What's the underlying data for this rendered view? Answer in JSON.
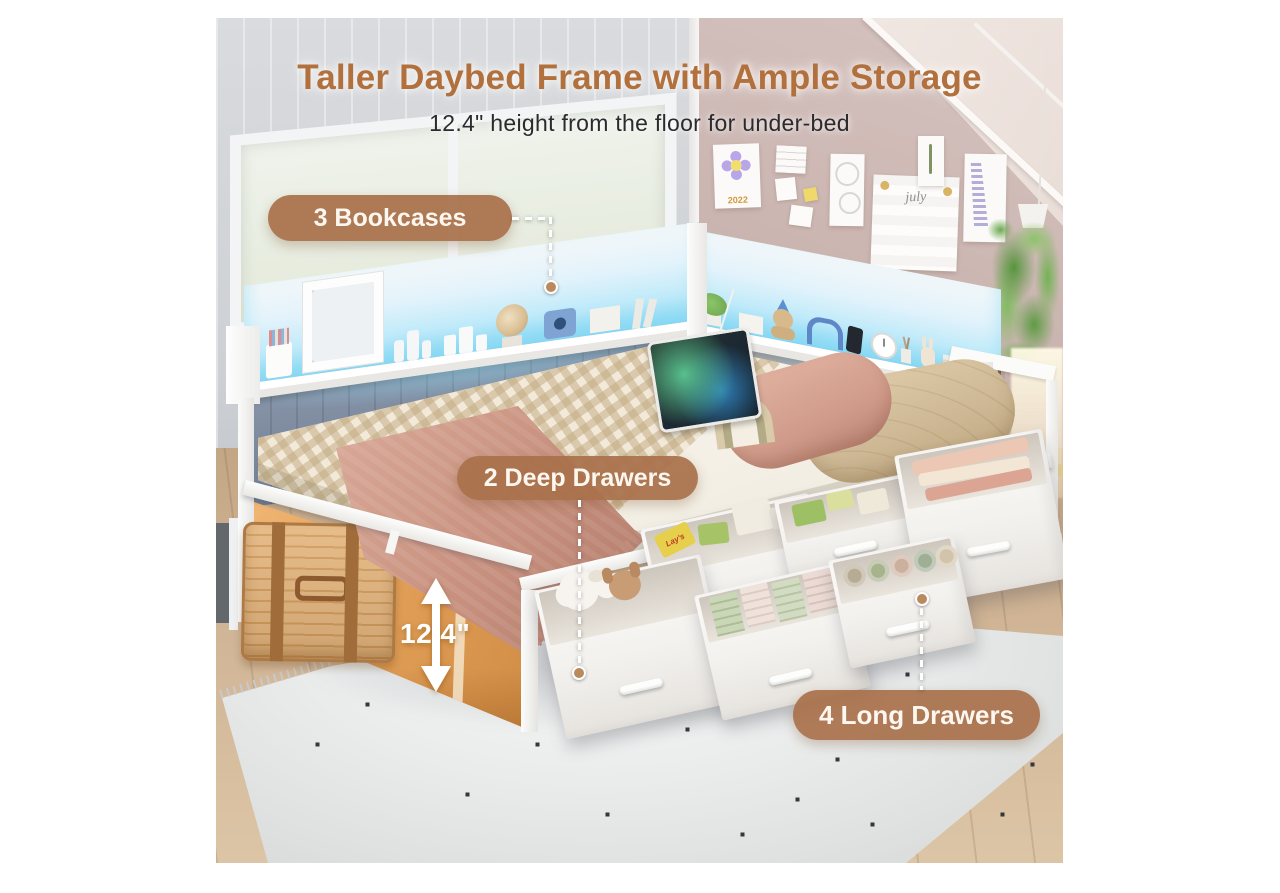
{
  "header": {
    "title": "Taller Daybed Frame with Ample Storage",
    "subtitle": "12.4\" height from the floor for under-bed"
  },
  "callouts": {
    "bookcases": {
      "label": "3 Bookcases"
    },
    "deep_drawers": {
      "label": "2 Deep Drawers"
    },
    "long_drawers": {
      "label": "4 Long Drawers"
    }
  },
  "measurement": {
    "label": "12.4\""
  },
  "photo_details": {
    "calendar_year": "2022",
    "planner_month": "july",
    "chips_brand": "Lay's"
  },
  "colors": {
    "accent-brown": "#b2703c",
    "badge-bg": "rgba(168,112,74,0.92)",
    "led-glow": "#93dbf4",
    "highlight-orange": "#e3a159"
  }
}
